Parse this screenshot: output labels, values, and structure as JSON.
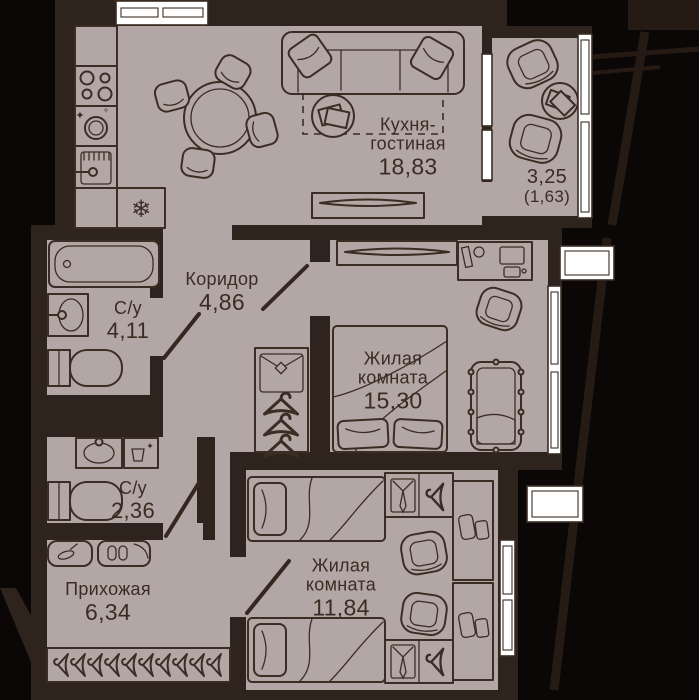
{
  "plan_type": "apartment-floor-plan",
  "language": "ru",
  "colors": {
    "background": "#0b0706",
    "wall": "#2f241d",
    "floor": "#b3a7a5",
    "furniture_line": "#3b2d24",
    "text": "#3a2c22",
    "window": "#ffffff",
    "exterior_structure": "#251b14"
  },
  "rooms": {
    "kitchen_living": {
      "name_lines": [
        "Кухня-",
        "гостиная"
      ],
      "area": "18,83"
    },
    "corridor": {
      "name": "Коридор",
      "area": "4,86"
    },
    "bathroom_1": {
      "name": "С/у",
      "area": "4,11"
    },
    "bedroom_1": {
      "name_lines": [
        "Жилая",
        "комната"
      ],
      "area": "15,30"
    },
    "bathroom_2": {
      "name": "С/у",
      "area": "2,36"
    },
    "hallway": {
      "name": "Прихожая",
      "area": "6,34"
    },
    "bedroom_2": {
      "name_lines": [
        "Жилая",
        "комната"
      ],
      "area": "11,84"
    },
    "balcony": {
      "area": "3,25",
      "area_reduced": "(1,63)"
    }
  },
  "icons": {
    "snowflake": "❄",
    "sparkle": "✦",
    "sparkle_alt": "✧"
  }
}
